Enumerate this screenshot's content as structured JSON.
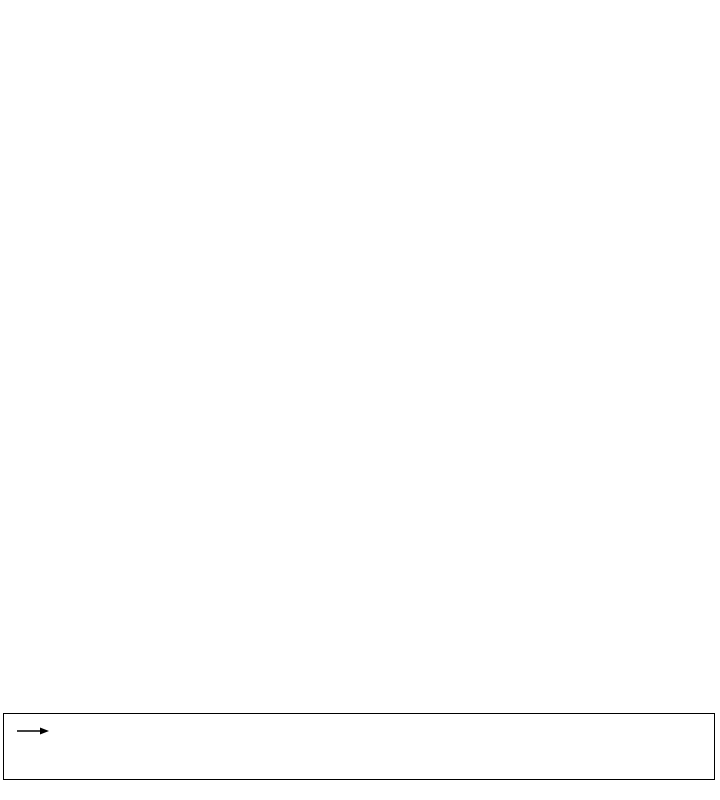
{
  "caption": {
    "bg_color": "#FFFFCC",
    "border_color": "#000000",
    "title": "Eastward Sea Water Velocity, Northward Sea Water Velocity (0.5 m s-1)",
    "line2": "RTOFS Forecast, 2D, 3-Hourly Prognostic, Global, Latest Model Run, today - today+8days",
    "line3": "(2026-02-06T03:00:00Z, Pressure=1.0 millibar)",
    "line4": "Data courtesy of NOAA NCEP",
    "reference_arrow": {
      "value": "0.5 m s-1",
      "icon": "right-arrow"
    }
  },
  "chart_data": {
    "type": "quiver",
    "title": "Eastward Sea Water Velocity, Northward Sea Water Velocity (0.5 m s-1)",
    "reference_vector_m_per_s": 0.5,
    "colors": {
      "sea": "#7d7d7d",
      "land": "#d2d2d2",
      "coast": "#3c3c3c",
      "frame": "#000000",
      "arrow": "#000000",
      "tick_label": "#000000"
    },
    "plot_px": {
      "left": 31,
      "top": 24,
      "width": 658,
      "height": 659
    },
    "axes": {
      "lon_min": 291.9,
      "lon_max": 295.3,
      "lat_min": 16.56,
      "lat_max": 19.96,
      "x_ticks": [
        {
          "value": 292.0,
          "label": "292°"
        },
        {
          "value": 292.5,
          "label": "292.5°"
        },
        {
          "value": 293.0,
          "label": "293°"
        },
        {
          "value": 293.5,
          "label": "293.5°"
        },
        {
          "value": 294.0,
          "label": "294°"
        },
        {
          "value": 294.5,
          "label": "294.5°"
        },
        {
          "value": 295.0,
          "label": "295°"
        }
      ],
      "y_ticks": [
        {
          "value": 16.5,
          "label": "16.5°"
        },
        {
          "value": 17.0,
          "label": "17°"
        },
        {
          "value": 17.5,
          "label": "17.5°"
        },
        {
          "value": 18.0,
          "label": "18°"
        },
        {
          "value": 18.5,
          "label": "18.5°"
        },
        {
          "value": 19.0,
          "label": "19°"
        },
        {
          "value": 19.5,
          "label": "19.5°"
        }
      ],
      "minor_step": 0.1,
      "major_tick_len": 6,
      "minor_tick_len": 3.5,
      "tick_font_px": 13
    },
    "grid": {
      "lon_start": 291.955,
      "lon_step": 0.1068,
      "cols": 32,
      "lat_start": 16.615,
      "lat_step": 0.1034,
      "rows": 33,
      "max_arrow_px": 24.5,
      "min_arrow_px": 3.5
    },
    "islands": [
      {
        "id": "puerto-rico",
        "points": [
          [
            292.799,
            18.443
          ],
          [
            292.825,
            18.474
          ],
          [
            292.98,
            18.454
          ],
          [
            293.135,
            18.469
          ],
          [
            293.342,
            18.443
          ],
          [
            293.497,
            18.464
          ],
          [
            293.652,
            18.448
          ],
          [
            293.807,
            18.469
          ],
          [
            293.936,
            18.443
          ],
          [
            294.04,
            18.454
          ],
          [
            294.143,
            18.428
          ],
          [
            294.21,
            18.443
          ],
          [
            294.272,
            18.402
          ],
          [
            294.324,
            18.417
          ],
          [
            294.365,
            18.381
          ],
          [
            294.386,
            18.325
          ],
          [
            294.35,
            18.268
          ],
          [
            294.303,
            18.227
          ],
          [
            294.22,
            18.196
          ],
          [
            294.117,
            18.18
          ],
          [
            293.962,
            18.165
          ],
          [
            293.859,
            18.186
          ],
          [
            293.807,
            18.139
          ],
          [
            293.678,
            18.17
          ],
          [
            293.549,
            18.144
          ],
          [
            293.445,
            18.118
          ],
          [
            293.316,
            18.134
          ],
          [
            293.239,
            18.108
          ],
          [
            293.125,
            18.129
          ],
          [
            293.032,
            18.103
          ],
          [
            292.939,
            18.123
          ],
          [
            292.851,
            18.144
          ],
          [
            292.799,
            18.175
          ],
          [
            292.753,
            18.237
          ],
          [
            292.732,
            18.289
          ],
          [
            292.742,
            18.34
          ],
          [
            292.773,
            18.392
          ]
        ]
      },
      {
        "id": "mona",
        "points": [
          [
            292.07,
            18.06
          ],
          [
            292.1,
            18.1
          ],
          [
            292.15,
            18.09
          ],
          [
            292.16,
            18.04
          ],
          [
            292.11,
            18.02
          ],
          [
            292.08,
            18.03
          ]
        ]
      },
      {
        "id": "desecheo",
        "points": [
          [
            292.47,
            18.395
          ],
          [
            292.5,
            18.405
          ],
          [
            292.52,
            18.39
          ],
          [
            292.49,
            18.375
          ]
        ]
      },
      {
        "id": "caja-de-muertos",
        "points": [
          [
            293.46,
            17.87
          ],
          [
            293.49,
            17.88
          ],
          [
            293.5,
            17.86
          ],
          [
            293.47,
            17.855
          ]
        ]
      },
      {
        "id": "vieques",
        "points": [
          [
            294.41,
            18.1
          ],
          [
            294.47,
            18.13
          ],
          [
            294.55,
            18.14
          ],
          [
            294.63,
            18.12
          ],
          [
            294.7,
            18.09
          ],
          [
            294.63,
            18.07
          ],
          [
            294.52,
            18.07
          ],
          [
            294.44,
            18.08
          ]
        ]
      },
      {
        "id": "culebra",
        "points": [
          [
            294.66,
            18.29
          ],
          [
            294.69,
            18.32
          ],
          [
            294.73,
            18.31
          ],
          [
            294.71,
            18.27
          ],
          [
            294.67,
            18.27
          ]
        ]
      },
      {
        "id": "st-thomas",
        "points": [
          [
            294.92,
            18.34
          ],
          [
            294.98,
            18.36
          ],
          [
            295.06,
            18.35
          ],
          [
            295.12,
            18.32
          ],
          [
            295.05,
            18.3
          ],
          [
            294.96,
            18.31
          ]
        ]
      },
      {
        "id": "st-john",
        "points": [
          [
            295.17,
            18.36
          ],
          [
            295.25,
            18.37
          ],
          [
            295.3,
            18.355
          ],
          [
            295.3,
            18.31
          ],
          [
            295.21,
            18.305
          ],
          [
            295.16,
            18.33
          ]
        ]
      },
      {
        "id": "tortola",
        "points": [
          [
            295.24,
            18.43
          ],
          [
            295.3,
            18.45
          ],
          [
            295.3,
            18.41
          ],
          [
            295.25,
            18.41
          ]
        ]
      },
      {
        "id": "st-croix",
        "points": [
          [
            295.06,
            17.73
          ],
          [
            295.12,
            17.77
          ],
          [
            295.2,
            17.78
          ],
          [
            295.29,
            17.76
          ],
          [
            295.3,
            17.71
          ],
          [
            295.26,
            17.66
          ],
          [
            295.16,
            17.66
          ],
          [
            295.08,
            17.69
          ]
        ]
      }
    ],
    "flow_features": [
      {
        "id": "west-fan",
        "type": "rotation_with_latitude",
        "base_angle_deg": 90,
        "max_extra_rotation_deg": 115,
        "rot_lat_start": 18.85,
        "rot_lat_span": 0.9,
        "strength": 0.5,
        "lat_floor": 17.5,
        "lat_floor_span": 0.6,
        "top_damp_start": 19.25,
        "top_damp_span": 0.7,
        "top_damp_max": 0.75,
        "lon_damp_start": 292.9,
        "lon_damp_span": 1.6,
        "lon_damp_max": 0.75,
        "band_suppress": {
          "lat_c": 18.62,
          "lat_sigma": 0.16,
          "lon_min": 292.95,
          "lon_max": 294.2,
          "edge": 0.15,
          "max": 0.7
        }
      },
      {
        "id": "mona-passage-jet",
        "type": "gaussian_jet",
        "lon_c": 292.72,
        "lon_sigma": 0.22,
        "lat_min": 17.1,
        "lat_max": 19.0,
        "edge": 0.4,
        "strength": 0.45,
        "fan": {
          "start": 18.35,
          "span": 0.6,
          "u": 0.3
        }
      },
      {
        "id": "north-coast-current",
        "type": "band",
        "lat_c": 18.62,
        "lat_sigma": 0.14,
        "lon_min": 292.85,
        "lon_max": 294.15,
        "edge": 0.25,
        "u": 0.5,
        "v_base": 0.08,
        "v_fan_start": 293.6,
        "v_fan_span": 0.6,
        "v_fan": 0.3
      },
      {
        "id": "south-coast-counterflow",
        "type": "band",
        "lat_c": 17.68,
        "lat_sigma": 0.17,
        "lon_min": 292.85,
        "lon_max": 294.1,
        "edge": 0.3,
        "u": -0.22,
        "v_base": 0,
        "v_fan": 0,
        "v_fan_start": 0,
        "v_fan_span": 1
      },
      {
        "id": "top-drift",
        "type": "top_band",
        "lat_start": 19.0,
        "lat_span": 0.95,
        "pow": 1.5,
        "strength": 0.25,
        "angle_base_deg": 185,
        "angle_per_lon_deg": 27,
        "lon_ref": 292,
        "east_damp_start": 292.5,
        "east_damp_span": 2.8,
        "east_damp_max": 0.6
      },
      {
        "id": "south-fan",
        "type": "south_fan",
        "w_start": 17.9,
        "w_span": 1.1,
        "pow": 1.1,
        "base": 0.25,
        "core_amp": 0.6,
        "core_lon": 293.8,
        "core_lon_sigma": 0.9,
        "core_lat": 16.7,
        "core_lat_sigma": 0.38,
        "east_damp_start": 294.65,
        "east_damp_span": 0.5,
        "east_damp_max": 0.8,
        "rot_lon_ref": 295.1,
        "rot_lon_span": 2.9,
        "rot_lat_ref": 17.6,
        "rot_lat_span": 1.0,
        "rot_max_deg": 125
      },
      {
        "id": "east-eddies",
        "type": "noise_patch",
        "lon_c": 294.95,
        "lon_sigma": 0.48,
        "lat_c": 18.05,
        "lat_sigma": 0.45,
        "amp": 0.18,
        "fu": [
          11,
          9
        ],
        "fv": [
          10,
          8
        ]
      },
      {
        "id": "east-ne-drift",
        "type": "gauss_uniform",
        "lon_c": 294.85,
        "lon_sigma": 0.45,
        "lat_c": 17.8,
        "lat_sigma": 0.28,
        "u": 0.16,
        "v": 0.13
      },
      {
        "id": "ambient-noise",
        "type": "global_noise",
        "amp": 0.05,
        "fu": [
          21.7,
          13.3
        ],
        "fv": [
          17.9,
          11.1
        ]
      }
    ]
  }
}
